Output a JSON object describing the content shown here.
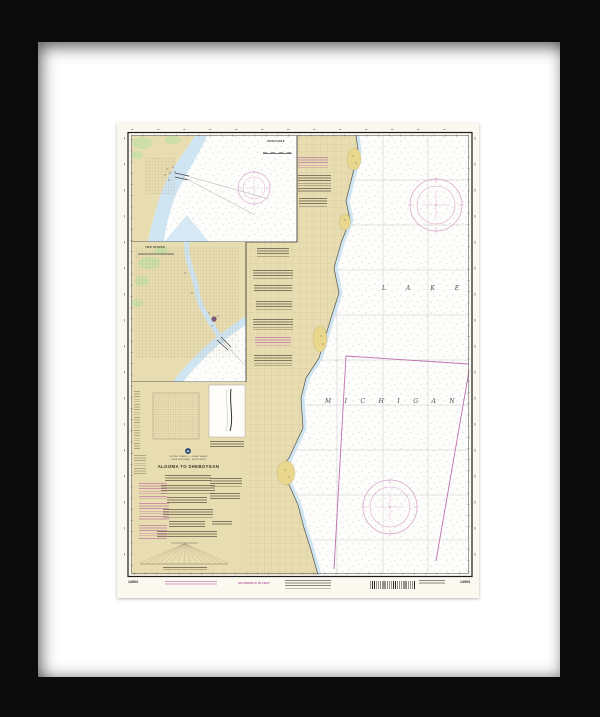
{
  "artwork": {
    "kind": "framed nautical chart print",
    "frame_color": "#0b0b0b",
    "matte_color": "#ffffff"
  },
  "chart": {
    "number": "14903",
    "nation_line": "UNITED STATES — GREAT LAKES",
    "region_line": "LAKE MICHIGAN · WISCONSIN",
    "title": "ALGOMA TO SHEBOYGAN",
    "soundings_note": "SOUNDINGS IN FEET",
    "lake_label_word1": "LAKE",
    "lake_label_word2": "MICHIGAN",
    "insets": [
      {
        "title": "KEWAUNEE"
      },
      {
        "title": "TWO RIVERS"
      }
    ],
    "icons": {
      "noaa_logo": "noaa-logo-icon",
      "compass_roses": [
        "compass-rose-icon",
        "compass-rose-icon",
        "compass-rose-icon"
      ]
    },
    "colors": {
      "paper": "#fbf8f0",
      "land_tan": "#e8dcb1",
      "shallow_blue": "#cfe5f2",
      "vegetation_green": "#ccdfa8",
      "built_up_yellow": "#e9d78d",
      "nav_magenta": "#b55aa4",
      "compass_magenta": "#d9a6ce"
    }
  }
}
